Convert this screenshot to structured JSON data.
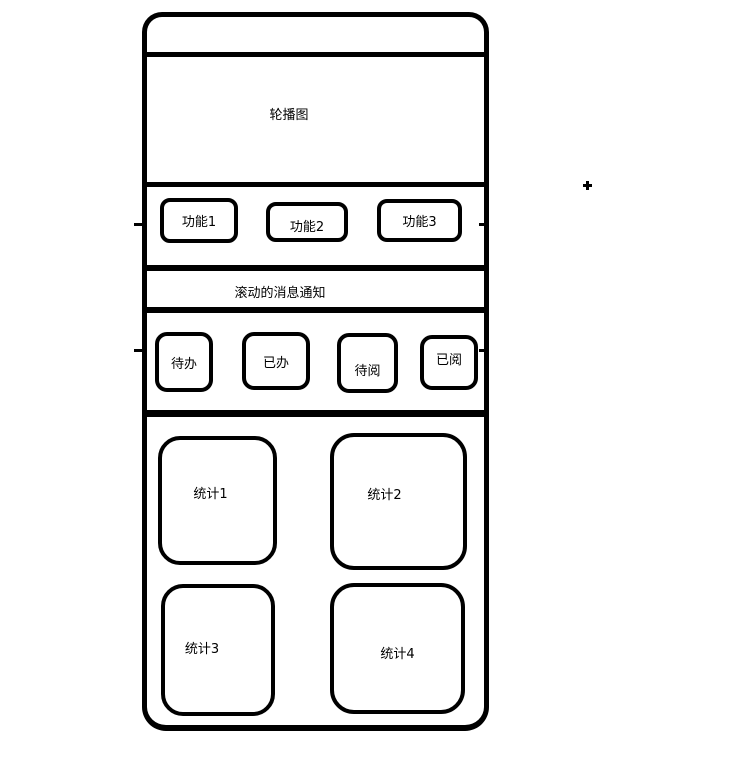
{
  "colors": {
    "stroke": "#000000",
    "background": "#ffffff"
  },
  "phone": {
    "carousel": {
      "label": "轮播图"
    },
    "functions": {
      "buttons": [
        {
          "label": "功能1"
        },
        {
          "label": "功能2"
        },
        {
          "label": "功能3"
        }
      ]
    },
    "notification": {
      "label": "滚动的消息通知"
    },
    "tabs": {
      "buttons": [
        {
          "label": "待办"
        },
        {
          "label": "已办"
        },
        {
          "label": "待阅"
        },
        {
          "label": "已阅"
        }
      ]
    },
    "stats": {
      "cards": [
        {
          "label": "统计1"
        },
        {
          "label": "统计2"
        },
        {
          "label": "统计3"
        },
        {
          "label": "统计4"
        }
      ]
    }
  }
}
